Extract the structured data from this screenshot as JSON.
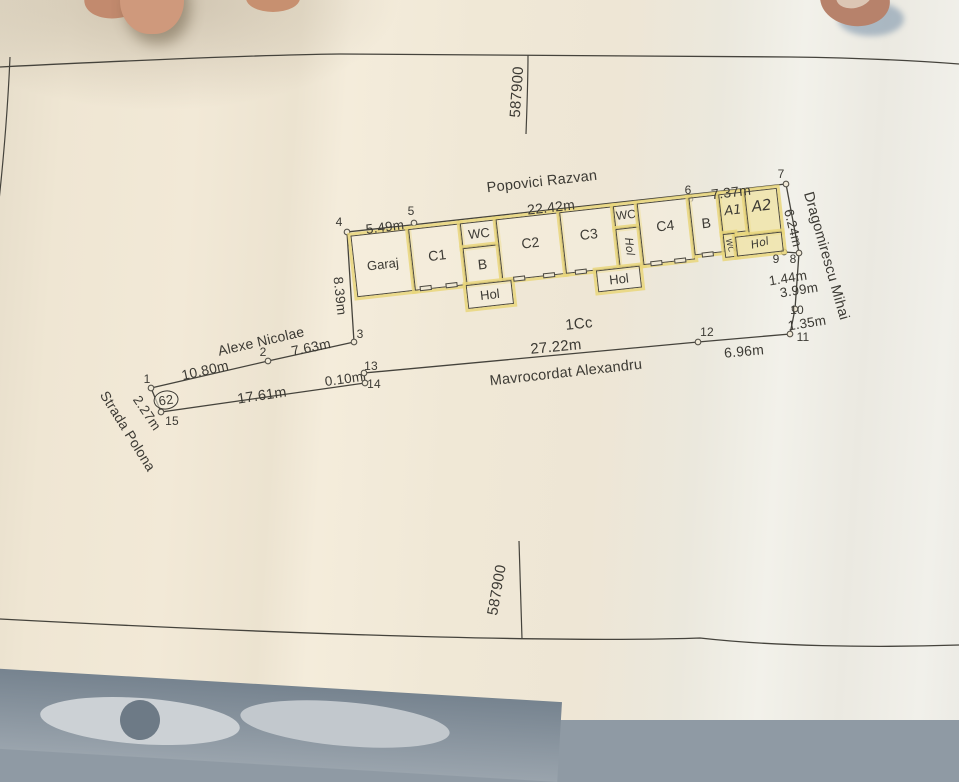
{
  "colors": {
    "paper": "#f0e8d6",
    "ink": "#3c3a34",
    "highlighter": "#e9d67b",
    "skin": "#c08a6f",
    "floor": "#8f9aa4"
  },
  "grid_labels": [
    {
      "name": "grid-coordinate-top",
      "text": "587900",
      "x": 517,
      "y": 92,
      "rot": -86,
      "size": 15
    },
    {
      "name": "grid-coordinate-bottom",
      "text": "587900",
      "x": 497,
      "y": 590,
      "rot": -80,
      "size": 15
    }
  ],
  "streets": [
    {
      "name": "street-popovici-razvan",
      "text": "Popovici Razvan",
      "x": 542,
      "y": 182,
      "rot": -6.5,
      "size": 14.5
    },
    {
      "name": "street-alexe-nicolae",
      "text": "Alexe Nicolae",
      "x": 261,
      "y": 341,
      "rot": -13,
      "size": 14
    },
    {
      "name": "street-mavrocordat-alexandru",
      "text": "Mavrocordat Alexandru",
      "x": 566,
      "y": 373,
      "rot": -6.3,
      "size": 14.5
    },
    {
      "name": "street-dragomirescu-mihai",
      "text": "Dragomirescu Mihai",
      "x": 826,
      "y": 256,
      "rot": 74,
      "size": 14.5
    },
    {
      "name": "street-strada-polona",
      "text": "Strada Polona",
      "x": 128,
      "y": 431,
      "rot": 58,
      "size": 14
    }
  ],
  "parcel_label": {
    "name": "parcel-label-1cc",
    "text": "1Cc",
    "x": 579,
    "y": 324,
    "rot": -6,
    "size": 15
  },
  "house_number": {
    "name": "house-number-62",
    "text": "62",
    "x": 166,
    "y": 400,
    "rot": -8,
    "size": 13
  },
  "dimensions": [
    {
      "text": "5.49m",
      "x": 385,
      "y": 227,
      "rot": -7,
      "size": 13.5
    },
    {
      "text": "22.42m",
      "x": 551,
      "y": 207,
      "rot": -6.5,
      "size": 14
    },
    {
      "text": "7.37m",
      "x": 731,
      "y": 192,
      "rot": -6.5,
      "size": 14
    },
    {
      "text": "6.24m",
      "x": 793,
      "y": 228,
      "rot": 76,
      "size": 13.5
    },
    {
      "text": "8.39m",
      "x": 340,
      "y": 296,
      "rot": 84,
      "size": 13.5
    },
    {
      "text": "10.80m",
      "x": 205,
      "y": 370,
      "rot": -12.5,
      "size": 14
    },
    {
      "text": "7.63m",
      "x": 311,
      "y": 347,
      "rot": -12,
      "size": 14
    },
    {
      "text": "2.27m",
      "x": 147,
      "y": 413,
      "rot": 56,
      "size": 13.5
    },
    {
      "text": "17.61m",
      "x": 262,
      "y": 396,
      "rot": -8.5,
      "size": 14.5
    },
    {
      "text": "0.10m",
      "x": 344,
      "y": 379,
      "rot": -8,
      "size": 13.5
    },
    {
      "text": "27.22m",
      "x": 556,
      "y": 347,
      "rot": -5.5,
      "size": 15
    },
    {
      "text": "6.96m",
      "x": 744,
      "y": 351,
      "rot": -5,
      "size": 14
    },
    {
      "text": "1.44m",
      "x": 788,
      "y": 278,
      "rot": -9,
      "size": 13.5
    },
    {
      "text": "3.99m",
      "x": 799,
      "y": 290,
      "rot": -9,
      "size": 13.5
    },
    {
      "text": "1.35m",
      "x": 807,
      "y": 323,
      "rot": -9,
      "size": 13.5
    }
  ],
  "point_numbers": [
    {
      "text": "1",
      "x": 147,
      "y": 379
    },
    {
      "text": "2",
      "x": 263,
      "y": 352
    },
    {
      "text": "3",
      "x": 360,
      "y": 334
    },
    {
      "text": "4",
      "x": 339,
      "y": 222
    },
    {
      "text": "5",
      "x": 411,
      "y": 211
    },
    {
      "text": "6",
      "x": 688,
      "y": 190
    },
    {
      "text": "7",
      "x": 781,
      "y": 174
    },
    {
      "text": "8",
      "x": 793,
      "y": 259
    },
    {
      "text": "9",
      "x": 776,
      "y": 259
    },
    {
      "text": "10",
      "x": 797,
      "y": 310
    },
    {
      "text": "11",
      "x": 803,
      "y": 337
    },
    {
      "text": "12",
      "x": 707,
      "y": 332
    },
    {
      "text": "13",
      "x": 371,
      "y": 366
    },
    {
      "text": "14",
      "x": 374,
      "y": 384
    },
    {
      "text": "15",
      "x": 172,
      "y": 421
    }
  ],
  "survey_points": [
    [
      151,
      388
    ],
    [
      268,
      361
    ],
    [
      354,
      342
    ],
    [
      347,
      232
    ],
    [
      414,
      223
    ],
    [
      690,
      199
    ],
    [
      786,
      184
    ],
    [
      799,
      253
    ],
    [
      784,
      252
    ],
    [
      795,
      309
    ],
    [
      790,
      334
    ],
    [
      698,
      342
    ],
    [
      364,
      373
    ],
    [
      365,
      383
    ],
    [
      161,
      412
    ]
  ],
  "boundary": [
    [
      151,
      388
    ],
    [
      268,
      361
    ],
    [
      354,
      342
    ],
    [
      347,
      232
    ],
    [
      786,
      184
    ],
    [
      799,
      253
    ],
    [
      795,
      309
    ],
    [
      790,
      334
    ],
    [
      698,
      342
    ],
    [
      364,
      373
    ],
    [
      365,
      383
    ],
    [
      161,
      412
    ],
    [
      151,
      388
    ]
  ],
  "step_segment": [
    [
      784,
      252
    ],
    [
      799,
      253
    ]
  ],
  "building": {
    "x": 347,
    "y": 232,
    "rot": -6.4,
    "rooms": [
      {
        "id": "garaj",
        "label": "Garaj",
        "x": 3,
        "y": 4,
        "w": 58,
        "h": 62,
        "lx": 32,
        "ly": 36,
        "size": 13
      },
      {
        "id": "c1",
        "label": "C1",
        "x": 61,
        "y": 4,
        "w": 52,
        "h": 62,
        "lx": 87,
        "ly": 33,
        "size": 14
      },
      {
        "id": "wc1",
        "label": "WC",
        "x": 113,
        "y": 4,
        "w": 36,
        "h": 25,
        "lx": 131,
        "ly": 16,
        "size": 13
      },
      {
        "id": "b1",
        "label": "B",
        "x": 113,
        "y": 29,
        "w": 36,
        "h": 37,
        "lx": 131,
        "ly": 47,
        "size": 14
      },
      {
        "id": "c2",
        "label": "C2",
        "x": 149,
        "y": 4,
        "w": 64,
        "h": 62,
        "lx": 181,
        "ly": 31,
        "size": 14
      },
      {
        "id": "c3",
        "label": "C3",
        "x": 213,
        "y": 4,
        "w": 54,
        "h": 62,
        "lx": 240,
        "ly": 29,
        "size": 14
      },
      {
        "id": "wc2",
        "label": "WC",
        "x": 267,
        "y": 4,
        "w": 24,
        "h": 23,
        "lx": 279,
        "ly": 14,
        "size": 12
      },
      {
        "id": "hol-vertical",
        "label": "Hol",
        "x": 267,
        "y": 27,
        "w": 24,
        "h": 39,
        "lx": 279,
        "ly": 46,
        "size": 11,
        "hand": true,
        "lrot": 90
      },
      {
        "id": "c4",
        "label": "C4",
        "x": 291,
        "y": 4,
        "w": 52,
        "h": 62,
        "lx": 317,
        "ly": 29,
        "size": 14
      },
      {
        "id": "b2",
        "label": "B",
        "x": 343,
        "y": 4,
        "w": 30,
        "h": 58,
        "lx": 358,
        "ly": 31,
        "size": 14
      },
      {
        "id": "a1",
        "label": "A1",
        "x": 373,
        "y": 4,
        "w": 26,
        "h": 40,
        "lx": 386,
        "ly": 22,
        "size": 13,
        "hand": true,
        "tint": true
      },
      {
        "id": "a2",
        "label": "A2",
        "x": 399,
        "y": 4,
        "w": 33,
        "h": 44,
        "lx": 415,
        "ly": 20,
        "size": 15,
        "hand": true,
        "tint": true
      },
      {
        "id": "wc3",
        "label": "WC",
        "x": 373,
        "y": 44,
        "w": 12,
        "h": 24,
        "lx": 379,
        "ly": 56,
        "size": 8,
        "hand": true,
        "lrot": 80,
        "tint": true
      },
      {
        "id": "hol-handwritten",
        "label": "Hol",
        "x": 385,
        "y": 48,
        "w": 47,
        "h": 20,
        "lx": 409,
        "ly": 57,
        "size": 11,
        "hand": true,
        "lrot": -8,
        "tint": true
      },
      {
        "id": "hol1",
        "label": "Hol",
        "x": 112,
        "y": 66,
        "w": 46,
        "h": 24,
        "lx": 135,
        "ly": 78,
        "size": 13
      },
      {
        "id": "hol2",
        "label": "Hol",
        "x": 243,
        "y": 66,
        "w": 44,
        "h": 22,
        "lx": 265,
        "ly": 77,
        "size": 13
      }
    ]
  }
}
